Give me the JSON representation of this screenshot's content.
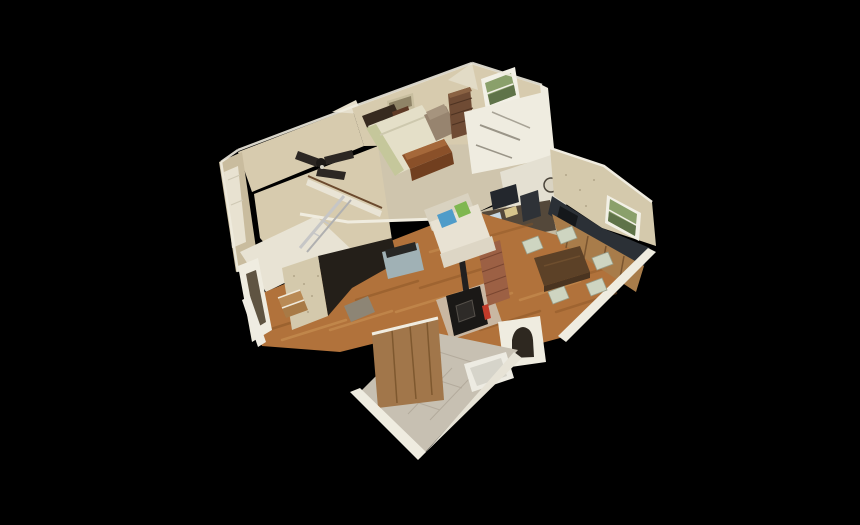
{
  "viewer": {
    "background": "#000000",
    "content": "3d-dollhouse-model",
    "visible_text": ""
  },
  "colors": {
    "background": "#000000",
    "wall_tan": "#d7cbae",
    "wall_tan_dark": "#c9bc9e",
    "wall_white": "#efece0",
    "wallpaper": "#d4c9ac",
    "carpet": "#cfc5ad",
    "hardwood": "#b1723b",
    "tile": "#c7c0b2",
    "counter": "#2b3036",
    "cabinet": "#a87c4a",
    "closet_wood": "#a1764a",
    "couch": "#e8e2d3",
    "pillow_blue": "#4f9cc9",
    "pillow_green": "#7fb750",
    "bedspread": "#e4dfc8",
    "headboard": "#372a1f",
    "cedar_chest": "#8a5029",
    "nightstand": "#5e3a26",
    "recliner": "#97846f",
    "dresser": "#6f4b34",
    "stove": "#1a1816",
    "brick": "#9c6044",
    "extinguisher": "#c23b2a",
    "table": "#5c4127",
    "chair": "#ced5c1",
    "tub": "#edebe2",
    "console": "#a0b1b5",
    "fan": "#2c2723",
    "window_glass": "#8aa06b",
    "window_frame": "#f2f0e6",
    "doormat": "#8d8575",
    "clock_face": "#d9d3c2",
    "metal": "#c6c6c6",
    "hearth": "#c9b7a2",
    "step_wood": "#b98a55"
  },
  "rooms": [
    "bedroom",
    "stairwell",
    "office-nook",
    "living-room",
    "dining-area",
    "kitchen",
    "hallway",
    "bathroom",
    "entry"
  ],
  "objects": [
    "bed",
    "headboard",
    "nightstand",
    "cedar-chest",
    "recliner-armchair",
    "dresser",
    "bedroom-window",
    "wall-niche",
    "ceiling-fan",
    "stair-railing",
    "metal-ladder",
    "stair-steps",
    "desk-clutter",
    "wall-clock",
    "couch",
    "throw-pillows",
    "media-console",
    "wood-stove",
    "brick-chimney",
    "fire-extinguisher",
    "dining-table",
    "dining-chairs",
    "kitchen-counter",
    "kitchen-cabinets",
    "kitchen-window",
    "doormat",
    "arched-doorway",
    "bathtub",
    "bathroom-closet"
  ]
}
